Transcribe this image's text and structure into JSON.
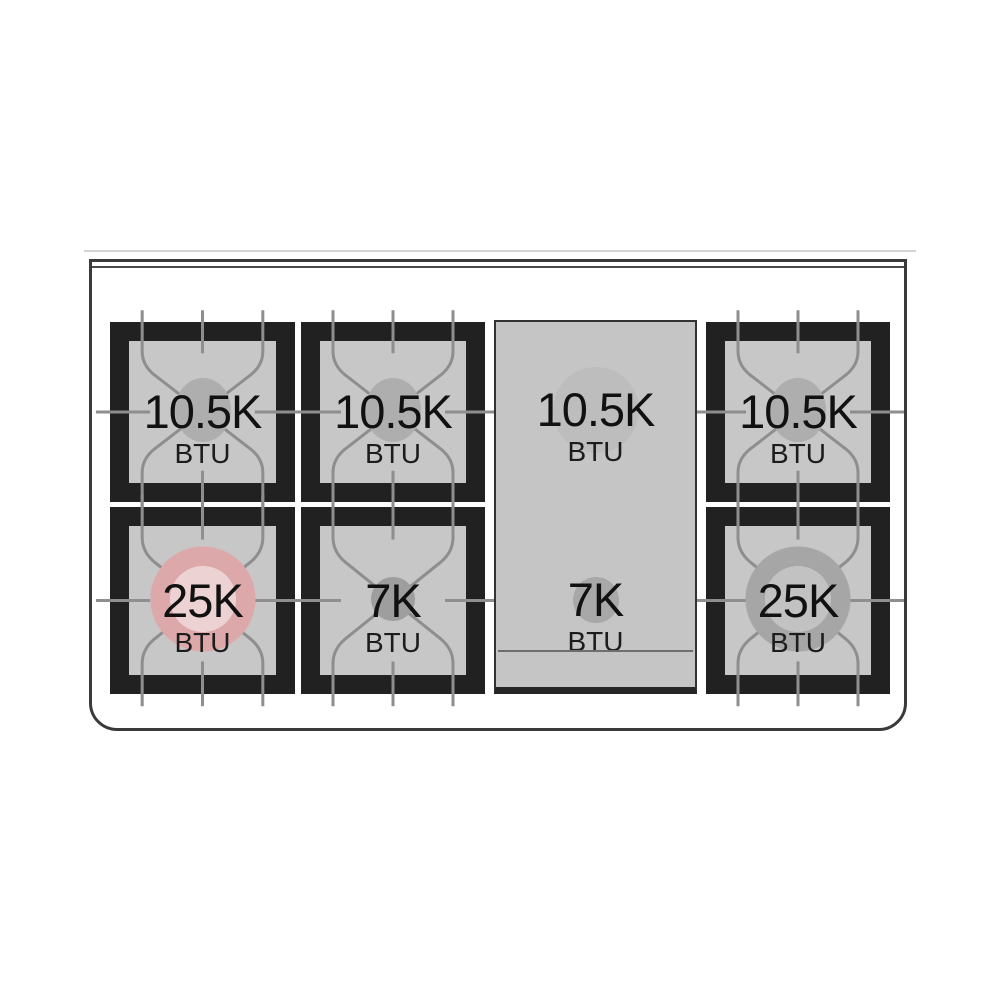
{
  "diagram": {
    "type": "gas-range-cooktop-btu-diagram",
    "burners": [
      {
        "position": "top-left",
        "value": "10.5K",
        "unit": "BTU"
      },
      {
        "position": "top-center",
        "value": "10.5K",
        "unit": "BTU"
      },
      {
        "position": "griddle-top",
        "value": "10.5K",
        "unit": "BTU"
      },
      {
        "position": "top-right",
        "value": "10.5K",
        "unit": "BTU"
      },
      {
        "position": "bottom-left",
        "value": "25K",
        "unit": "BTU"
      },
      {
        "position": "bottom-center",
        "value": "7K",
        "unit": "BTU"
      },
      {
        "position": "griddle-bottom",
        "value": "7K",
        "unit": "BTU"
      },
      {
        "position": "bottom-right",
        "value": "25K",
        "unit": "BTU"
      }
    ],
    "colors": {
      "frame": "#212121",
      "surface": "#c7c7c7",
      "grate_line": "#8e8e8e",
      "dual_ring_highlight": "#dca8aa",
      "text": "#111111"
    }
  }
}
